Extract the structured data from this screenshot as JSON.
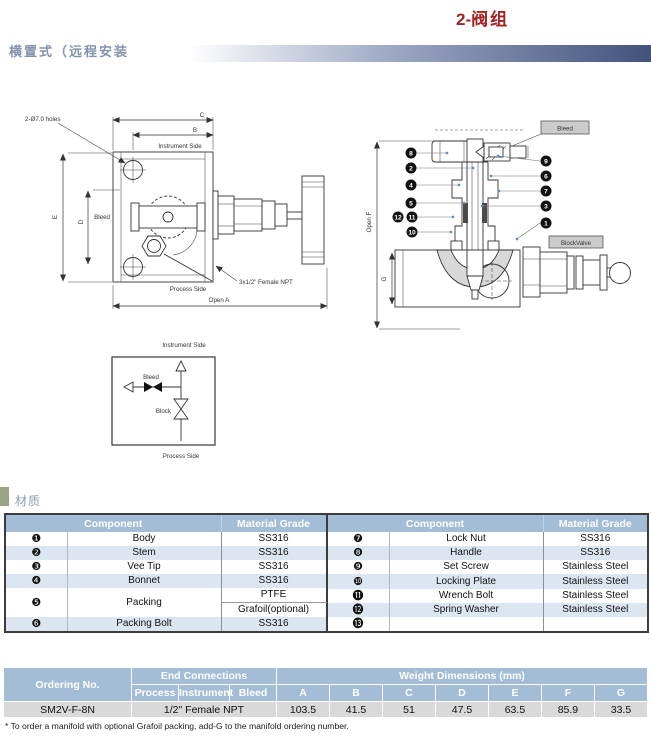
{
  "page": {
    "title_num": "2-",
    "title_zh": "阀组",
    "header": "横置式（远程安装",
    "section_material": "材质",
    "footnote": "* To order a manifold with optional Grafoil packing, add-G to the manifold ordering number."
  },
  "colors": {
    "title_red": "#a32121",
    "header_text_blue": "#8493ad",
    "table_header_blue": "#a3bdd6",
    "row_alt_blue": "#dce6f1",
    "data_row_gray": "#d9d9d9",
    "section_marker_olive": "#9aa384",
    "drawing_fill_gray": "#d8d8d8"
  },
  "drawing_front": {
    "labels": {
      "holes": "2-Ø7.0 holes",
      "dim_c": "C",
      "dim_b": "B",
      "dim_e": "E",
      "dim_d": "D",
      "instrument_side": "Instrument Side",
      "bleed": "Bleed",
      "process_side": "Process Side",
      "open_a": "Open A",
      "npt": "3x1/2\" Female NPT"
    }
  },
  "drawing_section": {
    "labels": {
      "bleed_tag": "Bleed",
      "block_tag": "BlockValve",
      "open_f": "Open F",
      "dim_g": "G"
    },
    "callouts": {
      "n1": "1",
      "n2": "2",
      "n3": "3",
      "n4": "4",
      "n5": "5",
      "n6": "6",
      "n7": "7",
      "n8": "8",
      "n9": "9",
      "n10": "10",
      "n11": "11",
      "n12": "12"
    }
  },
  "schematic": {
    "instrument_side": "Instrument Side",
    "process_side": "Process Side",
    "bleed": "Bleed",
    "block": "Block"
  },
  "materials_table": {
    "header_component": "Component",
    "header_grade": "Material Grade",
    "left_rows": [
      {
        "num": "❶",
        "name": "Body",
        "grade": "SS316"
      },
      {
        "num": "❷",
        "name": "Stem",
        "grade": "SS316"
      },
      {
        "num": "❸",
        "name": "Vee Tip",
        "grade": "SS316"
      },
      {
        "num": "❹",
        "name": "Bonnet",
        "grade": "SS316"
      }
    ],
    "packing": {
      "num": "❺",
      "name": "Packing",
      "grade1": "PTFE",
      "grade2": "Grafoil(optional)"
    },
    "packing_bolt": {
      "num": "❻",
      "name": "Packing Bolt",
      "grade": "SS316"
    },
    "right_rows": [
      {
        "num": "❼",
        "name": "Lock Nut",
        "grade": "SS316"
      },
      {
        "num": "❽",
        "name": "Handle",
        "grade": "SS316"
      },
      {
        "num": "❾",
        "name": "Set Screw",
        "grade": "Stainless Steel"
      },
      {
        "num": "❿",
        "name": "Locking Plate",
        "grade": "Stainless Steel"
      },
      {
        "num": "⓫",
        "name": "Wrench Bolt",
        "grade": "Stainless Steel"
      },
      {
        "num": "⓬",
        "name": "Spring Washer",
        "grade": "Stainless Steel"
      },
      {
        "num": "⓭",
        "name": "",
        "grade": ""
      }
    ]
  },
  "ordering_table": {
    "ordering_no_header": "Ordering No.",
    "end_connections": "End Connections",
    "process": "Process",
    "instrument": "Instrument",
    "bleed": "Bleed",
    "weight_dims": "Weight Dimensions (mm)",
    "dim_headers": [
      "A",
      "B",
      "C",
      "D",
      "E",
      "F",
      "G"
    ],
    "row": {
      "ordering_no": "SM2V-F-8N",
      "end_connection": "1/2\" Female NPT",
      "values": [
        "103.5",
        "41.5",
        "51",
        "47.5",
        "63.5",
        "85.9",
        "33.5"
      ]
    }
  }
}
